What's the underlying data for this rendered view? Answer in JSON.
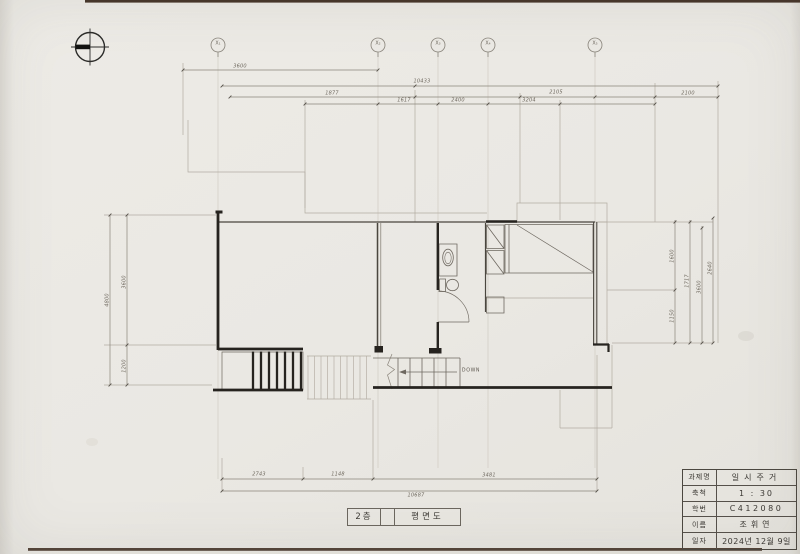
{
  "drawing": {
    "stair_label": "DOWN",
    "plan_title_cells": [
      "2층",
      "평면도"
    ],
    "grid_markers": [
      {
        "label": "X₁"
      },
      {
        "label": "X₂"
      },
      {
        "label": "X₃"
      },
      {
        "label": "X₄"
      },
      {
        "label": "X₅"
      }
    ],
    "dimensions": {
      "top": [
        {
          "text": "3600"
        },
        {
          "text": "10433"
        },
        {
          "text": "1877"
        },
        {
          "text": "2105"
        },
        {
          "text": "2100"
        },
        {
          "text": "1617"
        },
        {
          "text": "2400"
        },
        {
          "text": "3204"
        }
      ],
      "left": [
        {
          "text": "4800"
        },
        {
          "text": "3600"
        },
        {
          "text": "1200"
        }
      ],
      "right": [
        {
          "text": "1600"
        },
        {
          "text": "1150"
        },
        {
          "text": "1717"
        },
        {
          "text": "3600"
        },
        {
          "text": "2640"
        }
      ],
      "bottom": [
        {
          "text": "2743"
        },
        {
          "text": "1148"
        },
        {
          "text": "3481"
        },
        {
          "text": "10687"
        }
      ]
    }
  },
  "title_block": {
    "rows": [
      {
        "label": "과제명",
        "value": "일시주거"
      },
      {
        "label": "축척",
        "value": "1 : 30"
      },
      {
        "label": "학번",
        "value": "C412080"
      },
      {
        "label": "이름",
        "value": "조휘연"
      },
      {
        "label": "일자",
        "value": "2024년 12월 9일"
      }
    ]
  },
  "colors": {
    "paper": "#eae8e3",
    "wall_line": "#26231f",
    "medium_line": "#4a463f",
    "pencil_light": "#b2aca2",
    "dimension_line": "#8b857b",
    "scan_edge": "#46362b"
  }
}
